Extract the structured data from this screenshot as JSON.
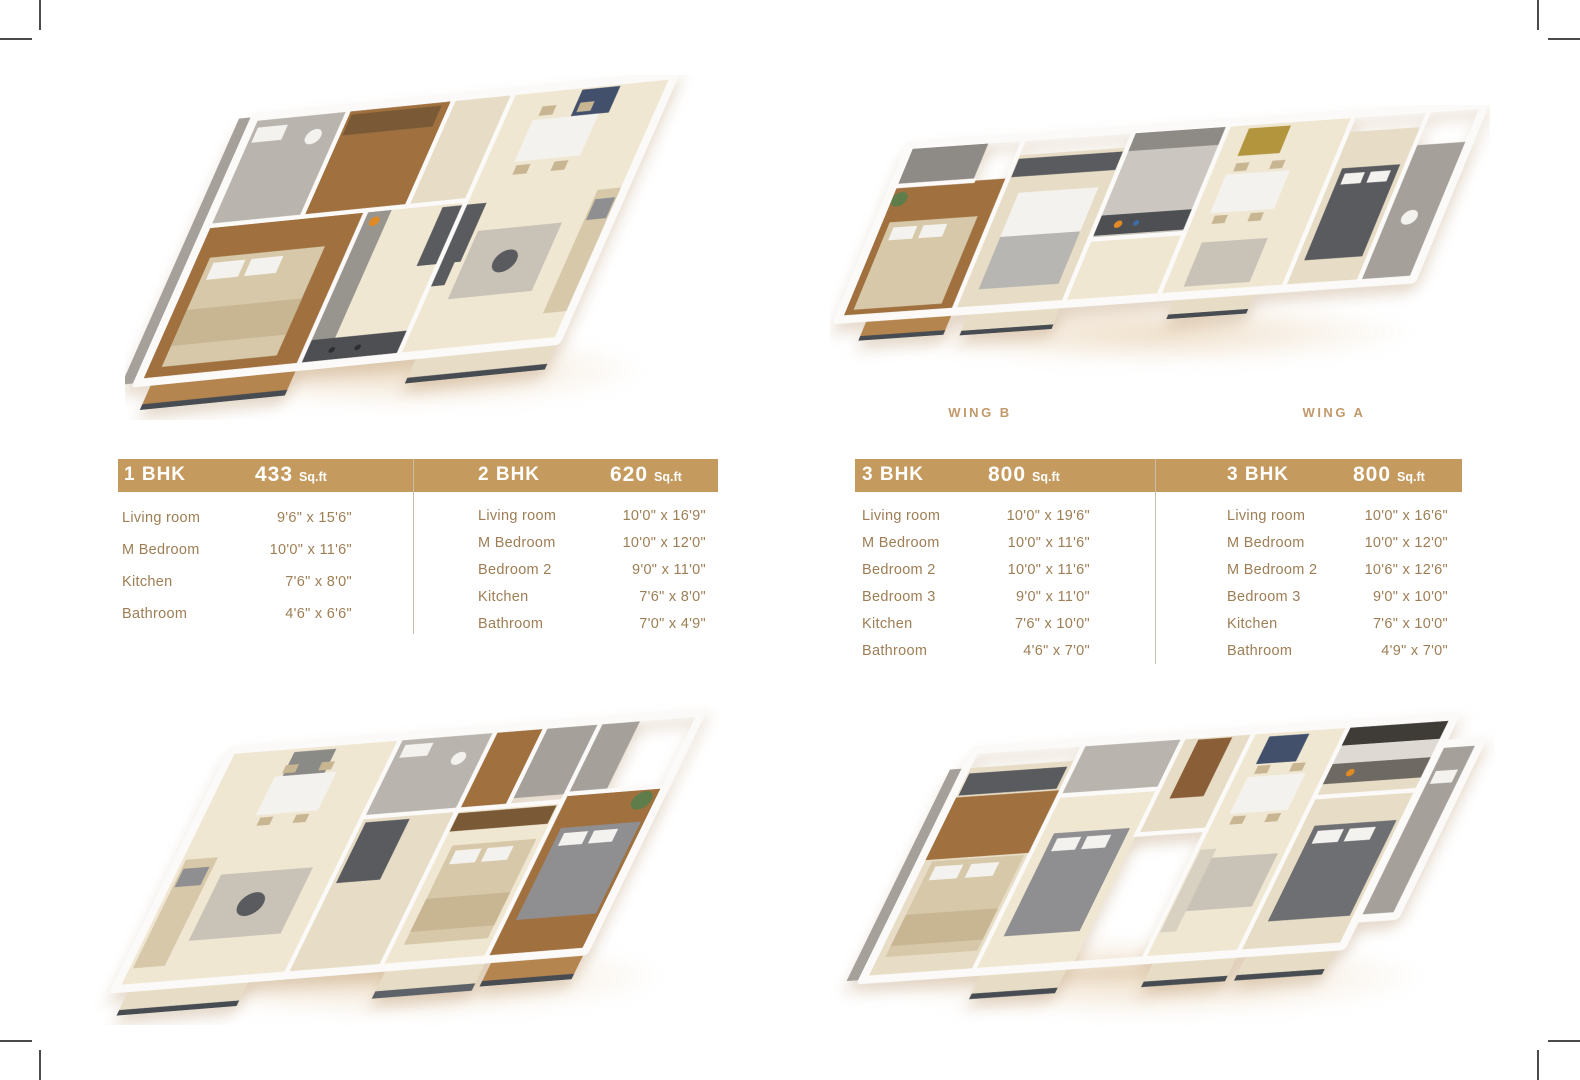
{
  "wings": {
    "b": "WING B",
    "a": "WING A"
  },
  "tables": [
    {
      "columns": [
        {
          "plan": "1 BHK",
          "area": "433",
          "unit": "Sq.ft",
          "rows": [
            {
              "room": "Living room",
              "size": "9'6\" x 15'6\""
            },
            {
              "room": "M Bedroom",
              "size": "10'0\" x 11'6\""
            },
            {
              "room": "Kitchen",
              "size": "7'6\" x 8'0\""
            },
            {
              "room": "Bathroom",
              "size": "4'6\" x 6'6\""
            }
          ]
        },
        {
          "plan": "2 BHK",
          "area": "620",
          "unit": "Sq.ft",
          "rows": [
            {
              "room": "Living room",
              "size": "10'0\" x 16'9\""
            },
            {
              "room": "M Bedroom",
              "size": "10'0\" x 12'0\""
            },
            {
              "room": "Bedroom 2",
              "size": "9'0\" x 11'0\""
            },
            {
              "room": "Kitchen",
              "size": "7'6\" x 8'0\""
            },
            {
              "room": "Bathroom",
              "size": "7'0\" x 4'9\""
            }
          ]
        }
      ]
    },
    {
      "columns": [
        {
          "plan": "3 BHK",
          "area": "800",
          "unit": "Sq.ft",
          "rows": [
            {
              "room": "Living room",
              "size": "10'0\" x 19'6\""
            },
            {
              "room": "M Bedroom",
              "size": "10'0\" x 11'6\""
            },
            {
              "room": "Bedroom 2",
              "size": "10'0\" x 11'6\""
            },
            {
              "room": "Bedroom 3",
              "size": "9'0\" x 11'0\""
            },
            {
              "room": "Kitchen",
              "size": "7'6\" x 10'0\""
            },
            {
              "room": "Bathroom",
              "size": "4'6\" x 7'0\""
            }
          ]
        },
        {
          "plan": "3 BHK",
          "area": "800",
          "unit": "Sq.ft",
          "rows": [
            {
              "room": "Living room",
              "size": "10'0\" x 16'6\""
            },
            {
              "room": "M Bedroom",
              "size": "10'0\" x 12'0\""
            },
            {
              "room": "M Bedroom 2",
              "size": "10'6\" x 12'6\""
            },
            {
              "room": "Bedroom 3",
              "size": "9'0\" x 10'0\""
            },
            {
              "room": "Kitchen",
              "size": "7'6\" x 10'0\""
            },
            {
              "room": "Bathroom",
              "size": "4'9\" x 7'0\""
            }
          ]
        }
      ]
    }
  ],
  "palette": {
    "accent": "#c49a5e",
    "text_brown": "#9d7e55",
    "wing_label": "#c2996a",
    "divider": "#c9bda9",
    "crop_mark": "#4b4b4b",
    "wall": "#fbfaf8",
    "concrete": "#a5a09a",
    "wood": "#a0703f",
    "wood_light": "#b5854f",
    "floor_cream": "#f0e7d3",
    "floor_cream2": "#e7dcc5",
    "tile": "#b9b5ae",
    "furn_beige": "#d6c8a8",
    "furn_white": "#f4f2ee",
    "furn_gray": "#8f8f92",
    "furn_dark": "#5a5b5f",
    "counter_dark": "#4e4f52",
    "slate": "#5d6269",
    "railing": "#474c52",
    "rug": "#c9c3b7",
    "art_dark": "#43506b",
    "accent_orange": "#e08a25",
    "plant_green": "#5f7d4a",
    "shadow_warm": "#ecd9bf",
    "page_bg": "#ffffff"
  }
}
